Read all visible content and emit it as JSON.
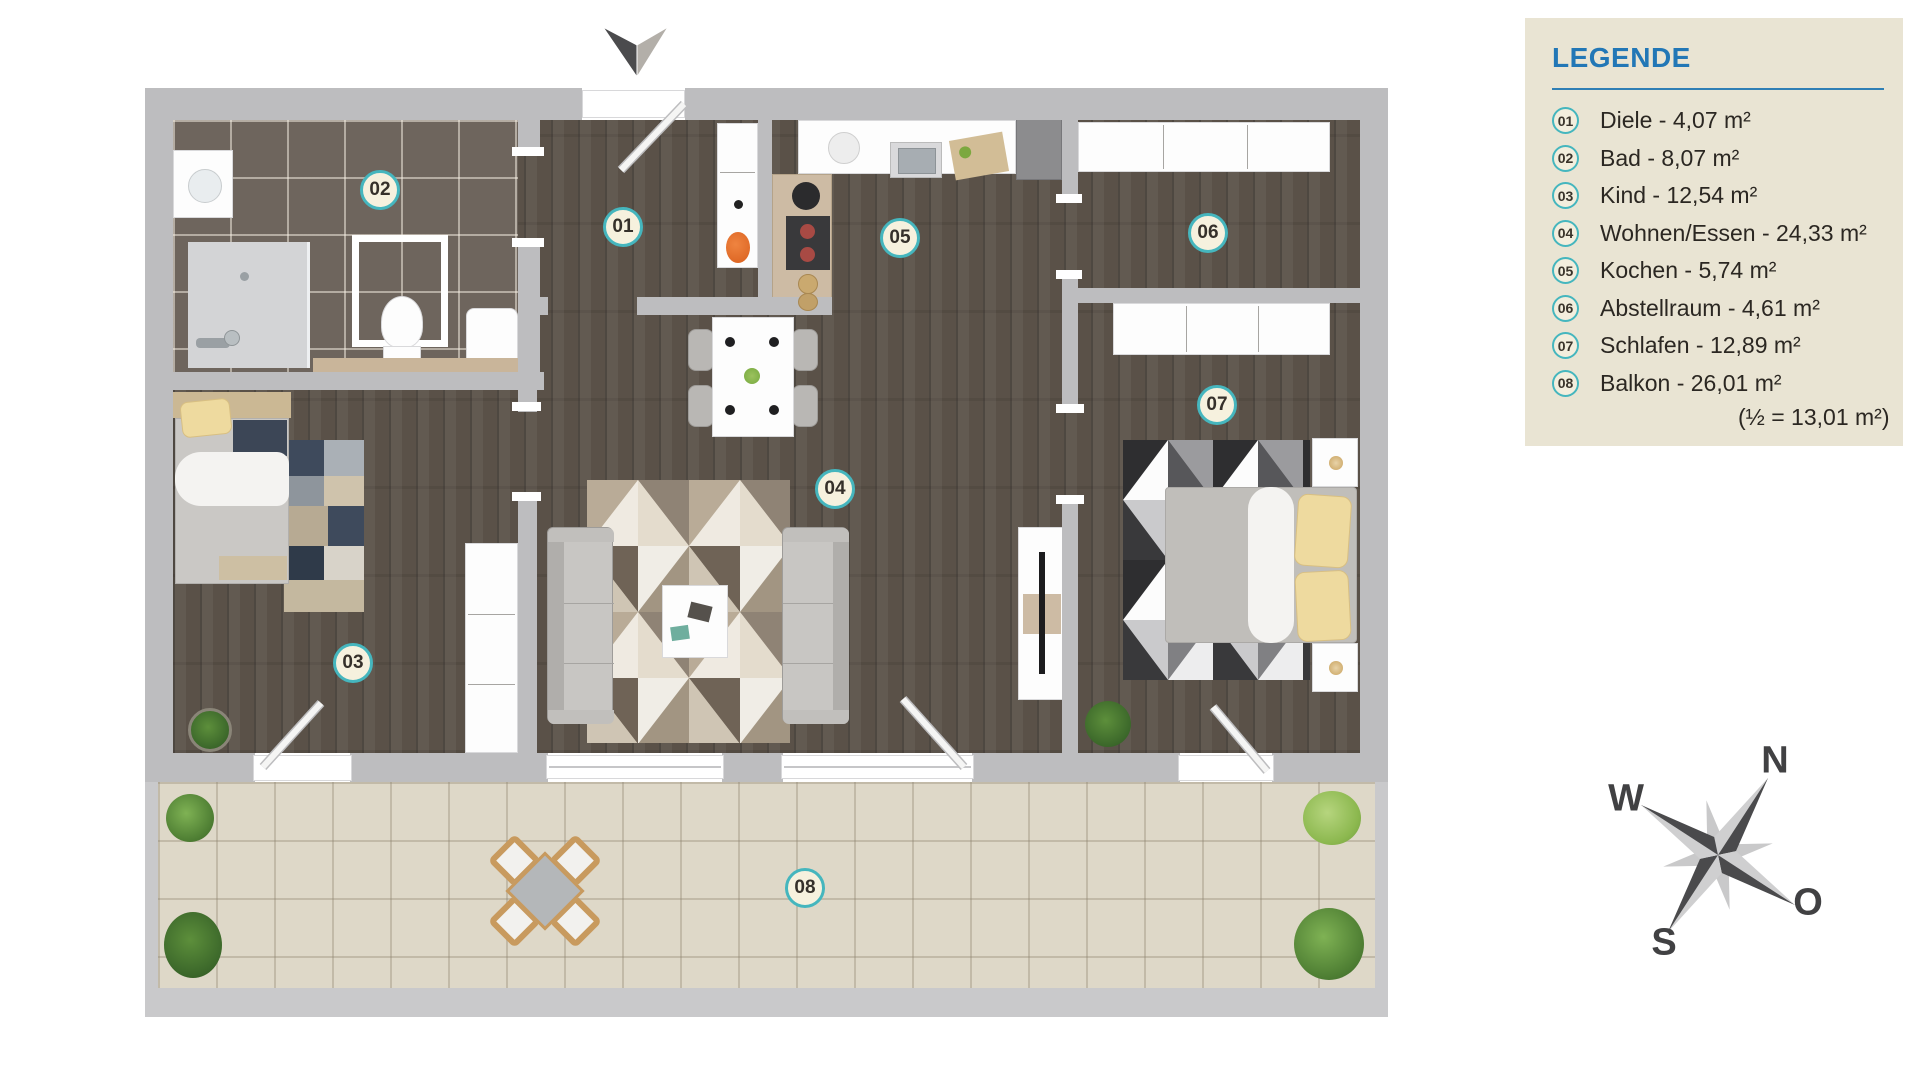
{
  "legend": {
    "title": "LEGENDE",
    "items": [
      {
        "number": "01",
        "label": "Diele - 4,07 m²"
      },
      {
        "number": "02",
        "label": "Bad - 8,07 m²"
      },
      {
        "number": "03",
        "label": "Kind - 12,54 m²"
      },
      {
        "number": "04",
        "label": "Wohnen/Essen - 24,33 m²"
      },
      {
        "number": "05",
        "label": "Kochen - 5,74 m²"
      },
      {
        "number": "06",
        "label": "Abstellraum - 4,61 m²"
      },
      {
        "number": "07",
        "label": "Schlafen - 12,89 m²"
      },
      {
        "number": "08",
        "label": "Balkon - 26,01 m²"
      }
    ],
    "footnote": "(½ = 13,01 m²)",
    "accent_blue": "#2277b6",
    "ring_teal": "#45b6be",
    "background": "#e9e4d3"
  },
  "plan": {
    "badges": [
      {
        "number": "01",
        "room": "Diele"
      },
      {
        "number": "02",
        "room": "Bad"
      },
      {
        "number": "03",
        "room": "Kind"
      },
      {
        "number": "04",
        "room": "Wohnen/Essen"
      },
      {
        "number": "05",
        "room": "Kochen"
      },
      {
        "number": "06",
        "room": "Abstellraum"
      },
      {
        "number": "07",
        "room": "Schlafen"
      },
      {
        "number": "08",
        "room": "Balkon"
      }
    ]
  },
  "compass": {
    "north": "N",
    "east": "O",
    "south": "S",
    "west": "W"
  }
}
